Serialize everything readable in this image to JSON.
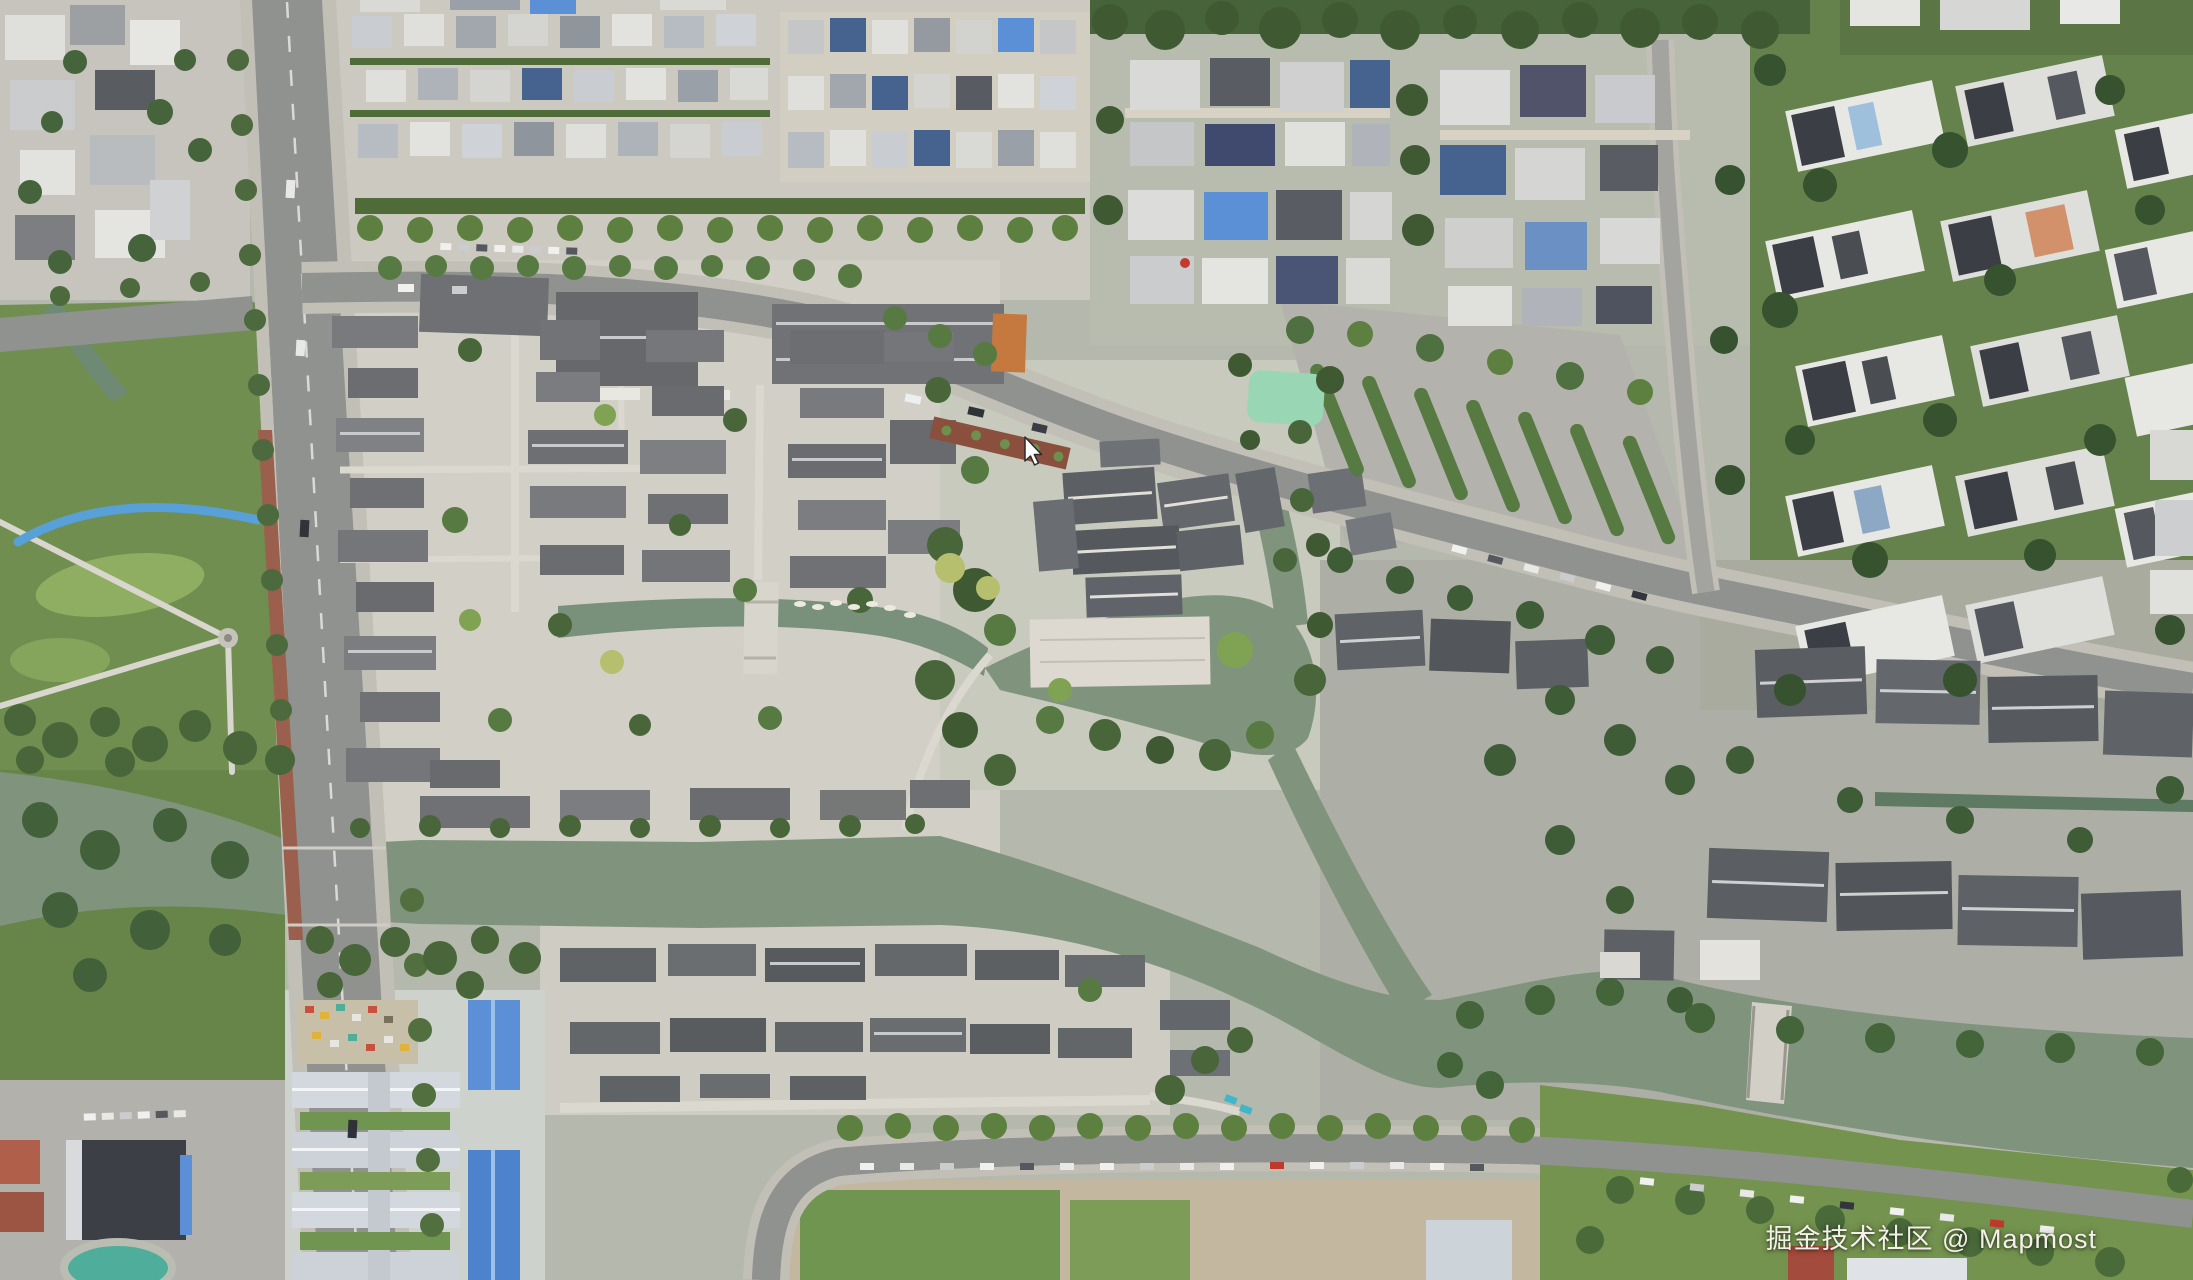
{
  "watermark": {
    "text": "掘金技术社区 @ Mapmost"
  },
  "cursor": {
    "x": 1025,
    "y": 437
  },
  "palette": {
    "base": "#b5b8ad",
    "water": "#80947d",
    "canal_dark": "#5e7a62",
    "road": "#909290",
    "road_minor": "#a3a3a0",
    "sidewalk": "#c2bfb7",
    "brick_walk": "#9b5f4e",
    "flowerbed": "#8a4f3d",
    "park_green": "#6f8e4f",
    "lawn_light": "#8fae62",
    "tree_dark": "#3f5a33",
    "tree_mid": "#567a42",
    "tree_light": "#7fa352",
    "tree_yellow": "#b6bf6e",
    "hedge": "#4e6b38",
    "historic_roof": "#73757a",
    "historic_roof_dark": "#5d6065",
    "ridge_light": "#c9cacb",
    "modern_white": "#e7e7e4",
    "modern_dark": "#3b3e44",
    "blue_roof": "#5b8fd6",
    "solar_blue": "#46628f",
    "orange_roof": "#c5793f",
    "plaza": "#ddd9d1",
    "dirt": "#c3b89f",
    "pond": "#99d6b4",
    "blue_slide": "#57a0d8",
    "pool_teal": "#4fae9b"
  }
}
